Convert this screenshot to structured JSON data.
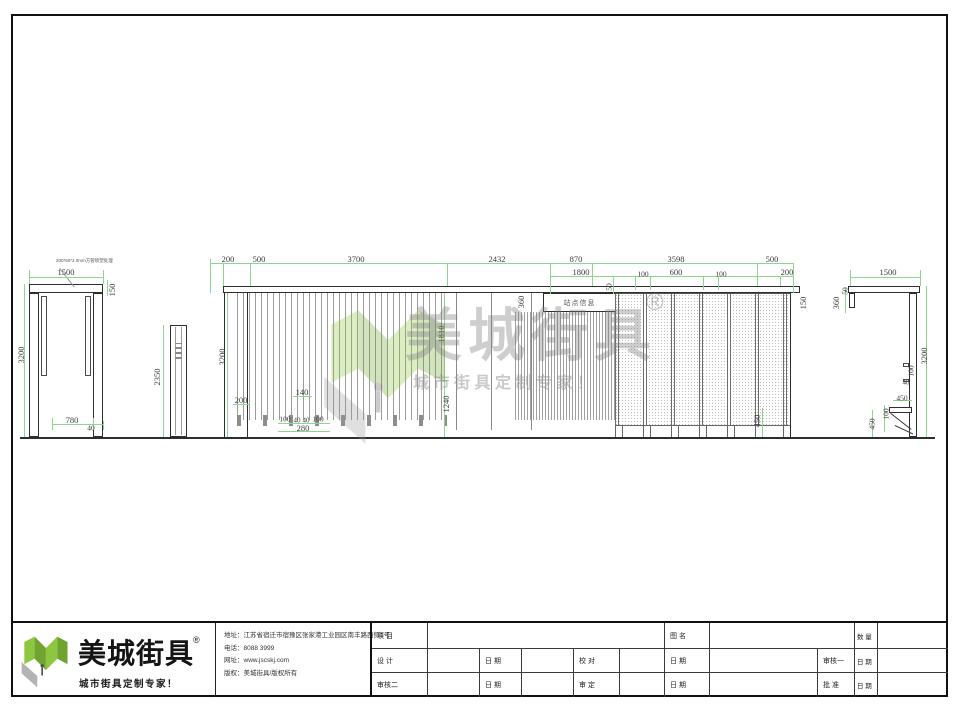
{
  "drawing": {
    "sign_text": "站点信息",
    "tube_note": "200*60*2.0mm方管喷塑处理",
    "dimensions": [
      {
        "t": "1500",
        "x": 66,
        "y": 272
      },
      {
        "t": "150",
        "x": 112,
        "y": 290,
        "r": 1
      },
      {
        "t": "3200",
        "x": 21,
        "y": 355,
        "r": 1
      },
      {
        "t": "780",
        "x": 72,
        "y": 420
      },
      {
        "t": "40",
        "x": 91,
        "y": 428,
        "s": 7.5
      },
      {
        "t": "2350",
        "x": 157,
        "y": 377,
        "r": 1
      },
      {
        "t": "200",
        "x": 228,
        "y": 259
      },
      {
        "t": "500",
        "x": 259,
        "y": 259
      },
      {
        "t": "3700",
        "x": 356,
        "y": 259
      },
      {
        "t": "2432",
        "x": 497,
        "y": 259
      },
      {
        "t": "870",
        "x": 576,
        "y": 259
      },
      {
        "t": "3598",
        "x": 676,
        "y": 259
      },
      {
        "t": "500",
        "x": 772,
        "y": 259
      },
      {
        "t": "1800",
        "x": 581,
        "y": 272
      },
      {
        "t": "100",
        "x": 643,
        "y": 274,
        "s": 7.5
      },
      {
        "t": "600",
        "x": 676,
        "y": 272
      },
      {
        "t": "100",
        "x": 721,
        "y": 274,
        "s": 7.5
      },
      {
        "t": "200",
        "x": 787,
        "y": 272
      },
      {
        "t": "50",
        "x": 609,
        "y": 287,
        "r": 1,
        "s": 7.5
      },
      {
        "t": "360",
        "x": 521,
        "y": 302,
        "r": 1
      },
      {
        "t": "150",
        "x": 803,
        "y": 303,
        "r": 1
      },
      {
        "t": "3200",
        "x": 222,
        "y": 357,
        "r": 1
      },
      {
        "t": "200",
        "x": 241,
        "y": 400
      },
      {
        "t": "140",
        "x": 302,
        "y": 392
      },
      {
        "t": "100",
        "x": 285,
        "y": 419,
        "s": 7.5
      },
      {
        "t": "40",
        "x": 297,
        "y": 421,
        "s": 7
      },
      {
        "t": "40",
        "x": 306,
        "y": 421,
        "s": 7
      },
      {
        "t": "100",
        "x": 318,
        "y": 419,
        "s": 7.5
      },
      {
        "t": "280",
        "x": 303,
        "y": 428
      },
      {
        "t": "1810",
        "x": 441,
        "y": 334,
        "r": 1
      },
      {
        "t": "1240",
        "x": 446,
        "y": 404,
        "r": 1
      },
      {
        "t": "450",
        "x": 757,
        "y": 421,
        "r": 1
      },
      {
        "t": "1500",
        "x": 888,
        "y": 272
      },
      {
        "t": "50",
        "x": 845,
        "y": 291,
        "r": 1,
        "s": 7.5
      },
      {
        "t": "360",
        "x": 836,
        "y": 303,
        "r": 1
      },
      {
        "t": "3200",
        "x": 924,
        "y": 356,
        "r": 1
      },
      {
        "t": "100",
        "x": 911,
        "y": 371,
        "r": 1,
        "s": 7.5
      },
      {
        "t": "40",
        "x": 906,
        "y": 383,
        "s": 7
      },
      {
        "t": "450",
        "x": 902,
        "y": 398,
        "s": 7.5
      },
      {
        "t": "100",
        "x": 886,
        "y": 414,
        "r": 1,
        "s": 7.5
      },
      {
        "t": "450",
        "x": 872,
        "y": 424,
        "r": 1,
        "s": 7.5
      }
    ]
  },
  "watermark": {
    "brand": "美城街具",
    "reg": "®",
    "tagline": "城市街具定制专家！"
  },
  "footer": {
    "brand": "美城街具",
    "reg": "®",
    "slogan": "城市街具定制专家！",
    "contact": {
      "address": "地址：江苏省宿迁市宿豫区张家港工业园区南丰路西侧1号",
      "phone": "电话：8088 3999",
      "web": "网址：www.jscskj.com",
      "copyright": "版权：美城街具/版权所有"
    },
    "table": {
      "project": "项 目",
      "drawing_name": "图 名",
      "quantity": "数 量",
      "design": "设 计",
      "date": "日 期",
      "proofread": "校 对",
      "review1": "审核一",
      "review2": "审核二",
      "verify": "审 定",
      "approve": "批 准"
    }
  },
  "colors": {
    "dim_line": "#8fd48f",
    "dim_text": "#3a3a3a",
    "cad_line": "#2e2e2e",
    "logo_green": "#8dc63f",
    "logo_green_dark": "#71a330",
    "logo_gray": "#b3b3b3"
  }
}
